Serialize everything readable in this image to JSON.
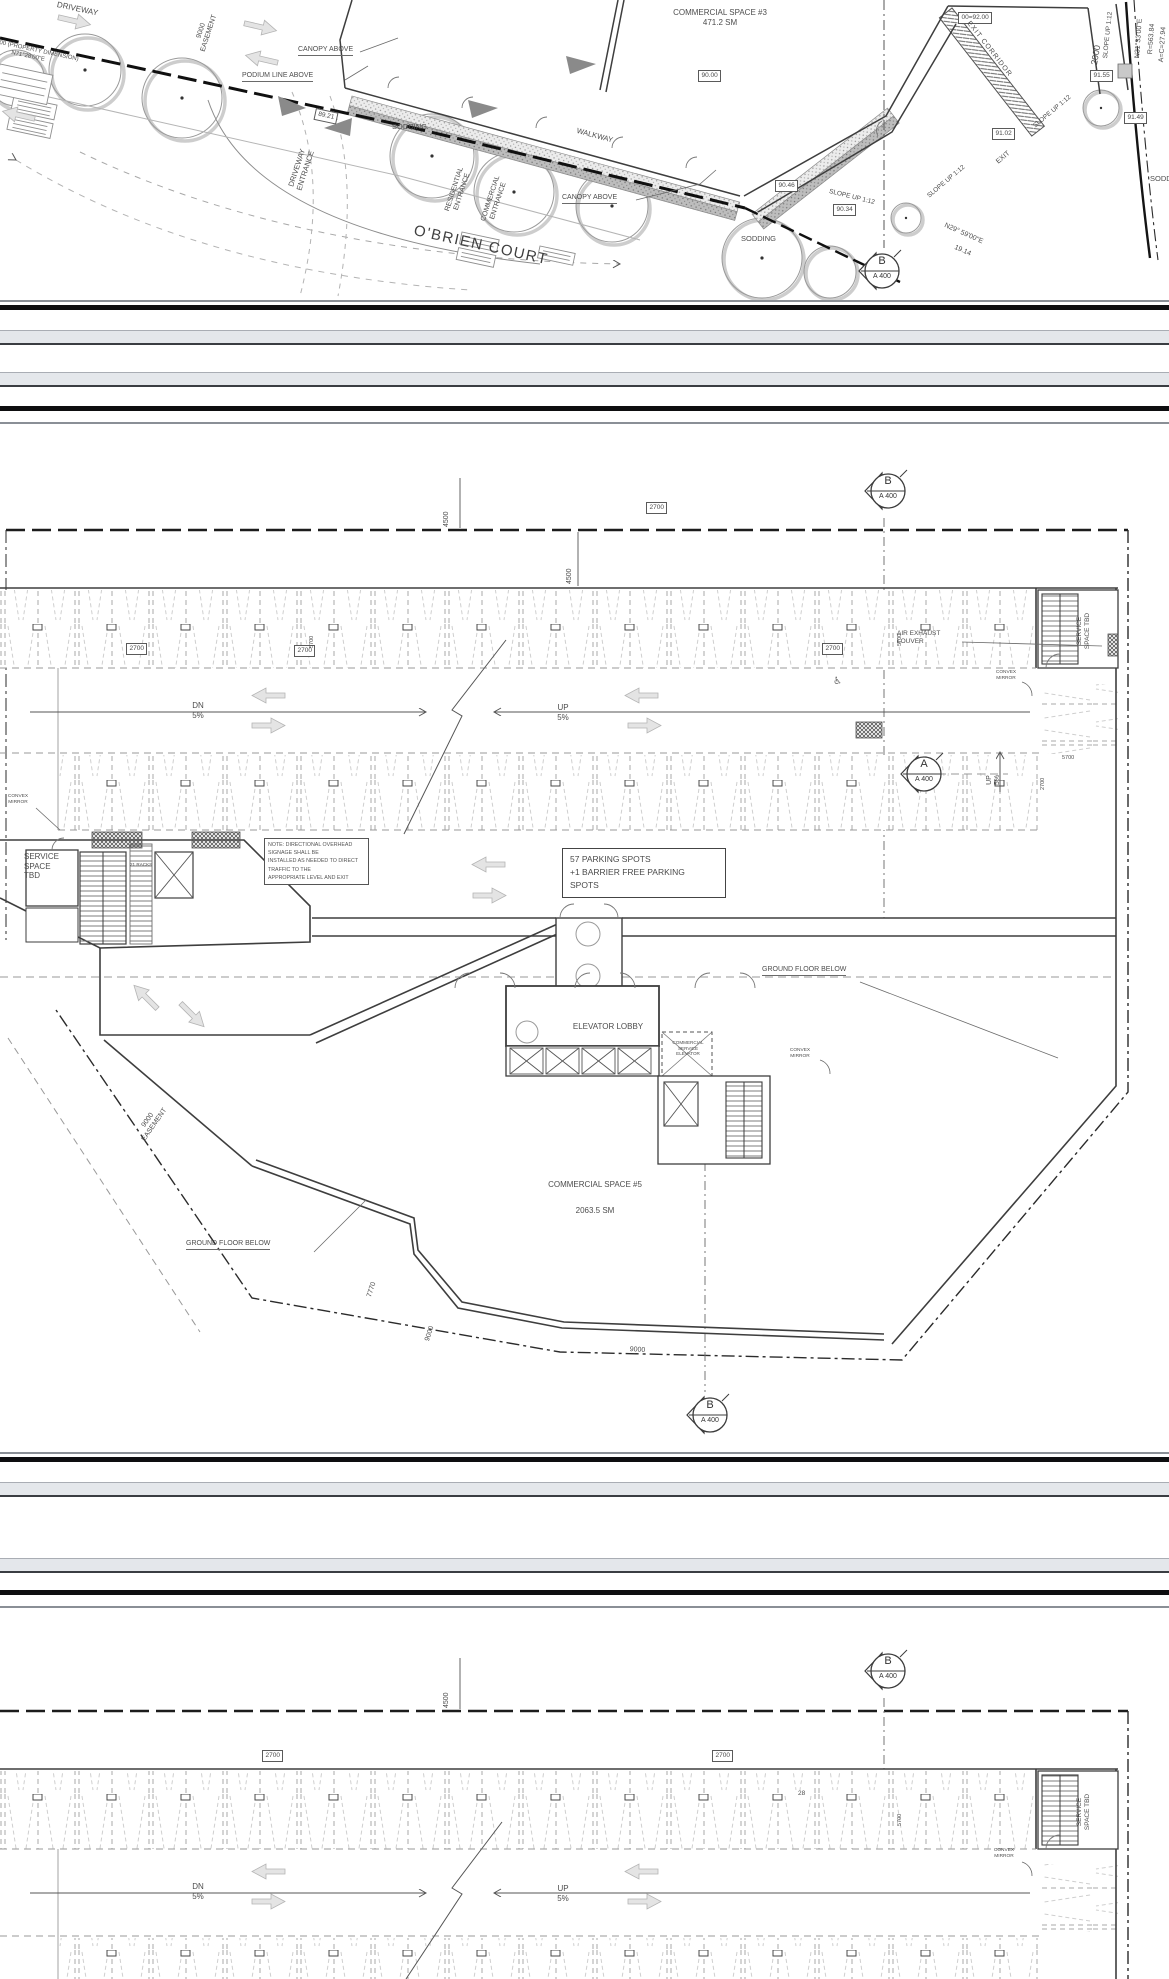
{
  "common": {
    "sec_b": "B",
    "sec_a": "A",
    "sheet": "A 400",
    "slope_up": "SLOPE UP 1:12",
    "sodding": "SODDING",
    "canopy_above": "CANOPY ABOVE",
    "walkway": "WALKWAY",
    "dn": "DN",
    "up": "UP",
    "grade": "5%",
    "dim_4500": "4500",
    "dim_2700": "2700",
    "dim_5700": "5700",
    "dim_9000": "9000",
    "dim_2000": "2000",
    "easement": "EASEMENT",
    "ground_floor_below": "GROUND FLOOR BELOW",
    "convex": "CONVEX",
    "mirror": "MIRROR",
    "service": "SERVICE",
    "space_tbd": "SPACE TBD",
    "driveway": "DRIVEWAY",
    "entrance": "ENTRANCE"
  },
  "top": {
    "commercial_space_3": "COMMERCIAL SPACE #3",
    "cs3_area": "471.2 SM",
    "obrien_court": "O'BRIEN COURT",
    "podium_line": "PODIUM LINE ABOVE",
    "residential": "RESIDENTIAL",
    "commercial": "COMMERCIAL",
    "exit": "EXIT",
    "exit_corridor": "EXIT CORRIDOR",
    "prop_dim": "00 (PROPERTY DIMENSION)",
    "prop_bearing": "N71°28'00\"E",
    "bearing_ne": "N31°33'00\"E",
    "radius": "R=563.84",
    "arc_len": "A=C=27.94",
    "bearing_se": "N29° 59'00\"E",
    "dist_se": "19.14",
    "tag_8921": "89.21",
    "tag_9000": "90.00",
    "tag_0092": "00=92.00",
    "tag_9155": "91.55",
    "tag_9102": "91.02",
    "tag_9149": "91.49",
    "tag_9046": "90.46",
    "tag_9034": "90.34"
  },
  "mid": {
    "service_tbd_l1": "SERVICE",
    "service_tbd_l2": "SPACE",
    "service_tbd_l3": "TBD",
    "note_l1": "NOTE: DIRECTIONAL OVERHEAD SIGNAGE SHALL BE",
    "note_l2": "INSTALLED AS NEEDED TO DIRECT TRAFFIC TO THE",
    "note_l3": "APPROPRIATE LEVEL AND EXIT",
    "racks": "21 RACKS",
    "parking_l1": "57 PARKING SPOTS",
    "parking_l2": "+1 BARRIER FREE PARKING",
    "parking_l3": "SPOTS",
    "elevator_lobby": "ELEVATOR LOBBY",
    "svc_elev_l1": "COMMERCIAL",
    "svc_elev_l2": "SERVICE",
    "svc_elev_l3": "ELEVATOR",
    "commercial_space_5": "COMMERCIAL SPACE #5",
    "cs5_area": "2063.5 SM",
    "dim_7770": "7770",
    "air_l1": "AIR EXHAUST",
    "air_l2": "LOUVER"
  },
  "bot": {
    "count_28": "28"
  }
}
